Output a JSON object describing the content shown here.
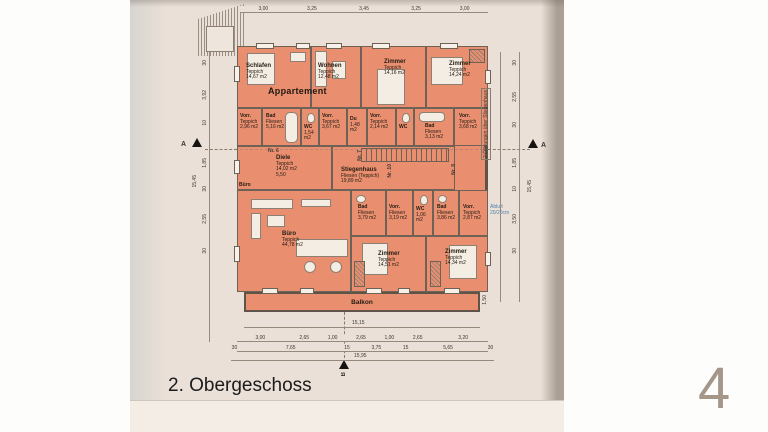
{
  "page": {
    "title": "2. Obergeschoss",
    "page_number": "4"
  },
  "plan": {
    "apartment_label": "Appartement",
    "buero_door_label": "Büro",
    "balkon_label": "Balkon",
    "rooms": [
      {
        "name": "Schlafen",
        "floor": "Teppich",
        "area": "14,67 m2"
      },
      {
        "name": "Wohnen",
        "floor": "Teppich",
        "area": "12,48 m2"
      },
      {
        "name": "Zimmer",
        "floor": "Teppich",
        "area": "14,16 m2"
      },
      {
        "name": "Zimmer",
        "floor": "Teppich",
        "area": "14,24 m2"
      },
      {
        "name": "Vorr.",
        "floor": "Teppich",
        "area": "2,96 m2"
      },
      {
        "name": "Bad",
        "floor": "Fliesen",
        "area": "5,16 m2"
      },
      {
        "name": "WC",
        "floor": "Fliesen",
        "area": "1,54 m2"
      },
      {
        "name": "Vorr.",
        "floor": "Teppich",
        "area": "3,67 m2"
      },
      {
        "name": "Du",
        "floor": "Fliesen",
        "area": "1,48 m2"
      },
      {
        "name": "Vorr.",
        "floor": "Teppich",
        "area": "2,14 m2"
      },
      {
        "name": "WC",
        "floor": "Fliesen",
        "area": ""
      },
      {
        "name": "Bad",
        "floor": "Fliesen",
        "area": "3,13 m2"
      },
      {
        "name": "Vorr.",
        "floor": "Teppich",
        "area": "3,68 m2"
      },
      {
        "name": "Diele",
        "floor": "Teppich",
        "area": "14,02 m2",
        "extra": "5,50"
      },
      {
        "name": "Stiegenhaus",
        "floor": "Fliesen (Teppich)",
        "area": "19,89 m2"
      },
      {
        "name": "Büro",
        "floor": "Teppich",
        "area": "44,78 m2"
      },
      {
        "name": "Bad",
        "floor": "Fliesen",
        "area": "3,79 m2"
      },
      {
        "name": "Vorr.",
        "floor": "Fliesen",
        "area": "3,19 m2"
      },
      {
        "name": "WC",
        "floor": "Fliesen",
        "area": "1,06 m2"
      },
      {
        "name": "Bad",
        "floor": "Fliesen",
        "area": "3,86 m2"
      },
      {
        "name": "Vorr.",
        "floor": "Teppich",
        "area": "2,87 m2"
      },
      {
        "name": "Zimmer",
        "floor": "Teppich",
        "area": "14,51 m2"
      },
      {
        "name": "Zimmer",
        "floor": "Teppich",
        "area": "14,34 m2"
      }
    ],
    "door_numbers": [
      "Nr. 6",
      "Nr. 7",
      "Nr. 10",
      "Nr. 8"
    ],
    "annotations": {
      "stiegenhaus_note": "2 Öffnungen über Stiegenhaus",
      "abluft_note": "Abluft 20/20cm"
    },
    "section_markers": {
      "a": "A",
      "b": "B"
    }
  },
  "dims": {
    "top": [
      "3,00",
      "3,25",
      "3,45",
      "3,25",
      "3,00"
    ],
    "balkon_width": "15,15",
    "balkon_depth": "1,50",
    "bottom_row1": [
      "3,00",
      "2,65",
      "1,00",
      "2,65",
      "1,00",
      "2,65",
      "3,20"
    ],
    "bottom_row2": [
      "30",
      "7,65",
      "15",
      "3,75",
      "15",
      "5,65",
      "30"
    ],
    "bottom_total": "15,95",
    "left": [
      "30",
      "3,92",
      "10",
      "1,85",
      "30",
      "2,55",
      "30"
    ],
    "left_total": "15,45",
    "right": [
      "30",
      "2,55",
      "30",
      "1,85",
      "10",
      "3,50",
      "30"
    ],
    "right_total": "15,45"
  }
}
